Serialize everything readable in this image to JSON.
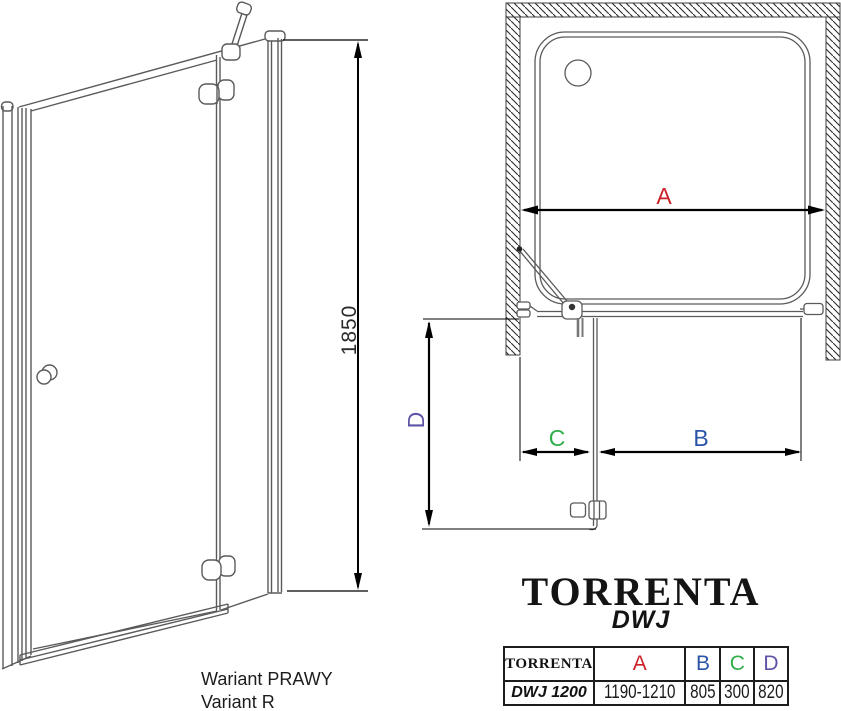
{
  "title_block": {
    "brand": "TORRENTA",
    "model": "DWJ"
  },
  "front_view": {
    "height_label": "1850",
    "variant_line1": "Wariant PRAWY",
    "variant_line2": "Variant R"
  },
  "plan_view": {
    "dim_a": "A",
    "dim_b": "B",
    "dim_c": "C",
    "dim_d": "D"
  },
  "colors": {
    "dim_a": "#cc2127",
    "dim_b": "#2b54a7",
    "dim_c": "#2fae4a",
    "dim_d": "#5e54a7",
    "drawing_line": "#5a5a5a",
    "dimension_line": "#000000"
  },
  "table": {
    "columns": [
      "TORRENTA",
      "A",
      "B",
      "C",
      "D"
    ],
    "rows": [
      {
        "model": "DWJ 1200",
        "a": "1190-1210",
        "b": "805",
        "c": "300",
        "d": "820"
      }
    ]
  }
}
